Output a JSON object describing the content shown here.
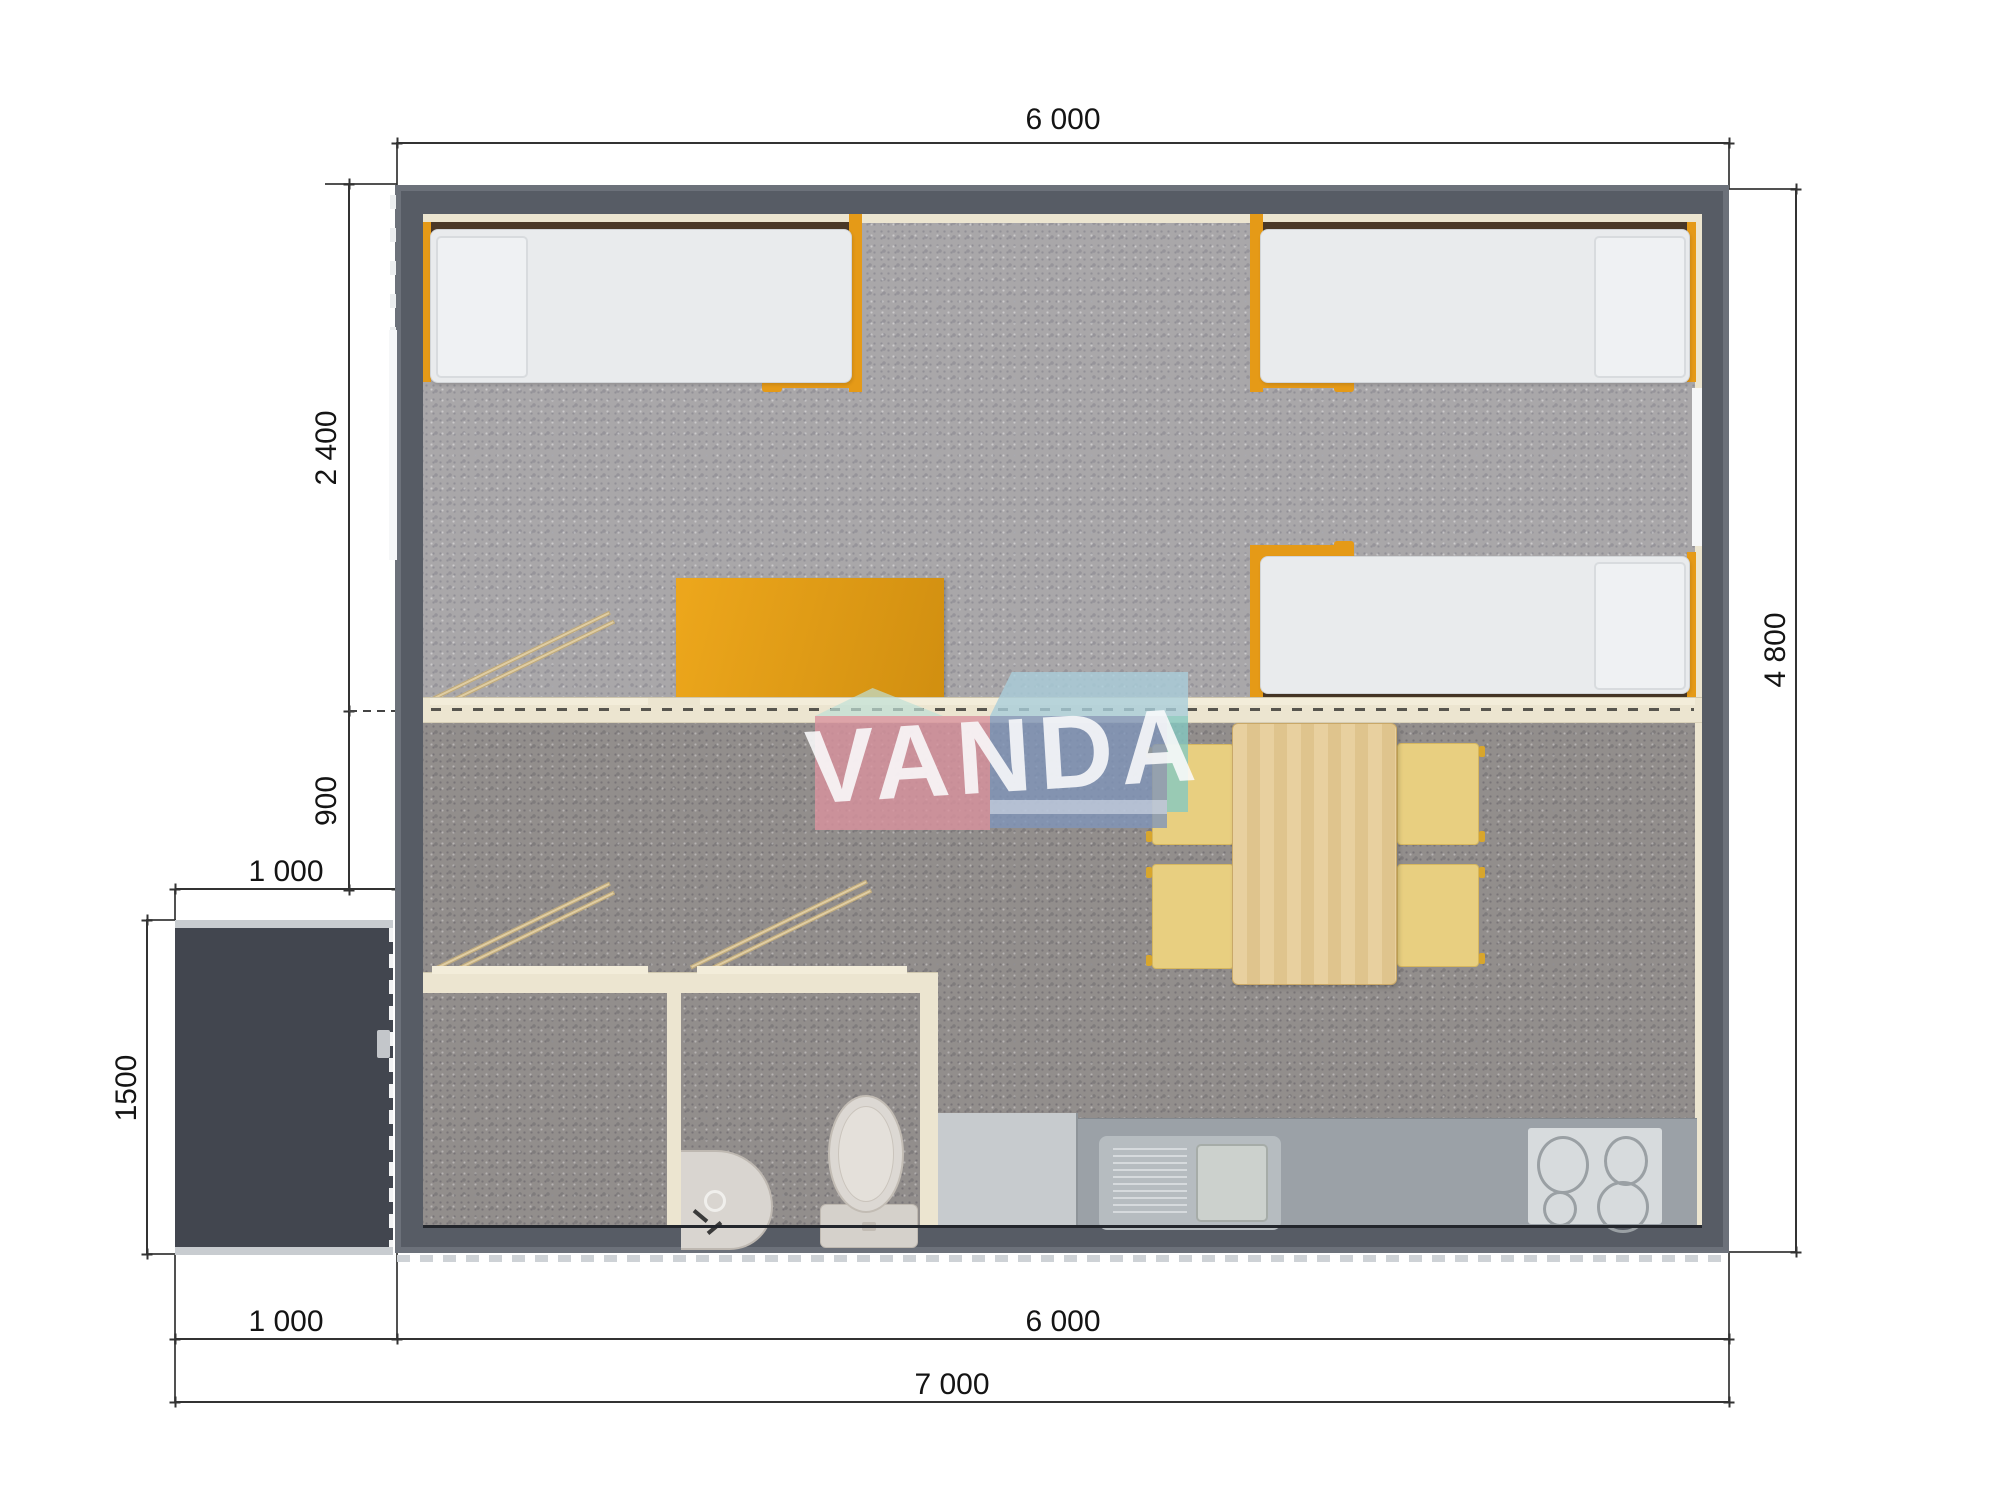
{
  "watermark": {
    "text": "VANDA",
    "pink": "#d9929e",
    "blue": "#8095b9",
    "teal": "#85c8c0",
    "skyblue": "#a9cdda"
  },
  "dims": {
    "top_width": "6 000",
    "bedroom_depth": "2 400",
    "hall_depth": "900",
    "porch_width": "1 000",
    "porch_depth": "1500",
    "right_height": "4 800",
    "bottom_porch": "1 000",
    "bottom_main": "6 000",
    "bottom_total": "7 000"
  },
  "colors": {
    "wall": "#575c65",
    "porch": "#42464f",
    "floor_bedroom": "#a9a7a9",
    "floor_living": "#928e8c",
    "interior_trim": "#ece5d0",
    "accent_orange": "#e59a17",
    "table_wood": "#e4cb96",
    "chair_yellow": "#e8cf80",
    "kitchen_counter": "#9ba1a7",
    "dimension_line": "#333333"
  }
}
